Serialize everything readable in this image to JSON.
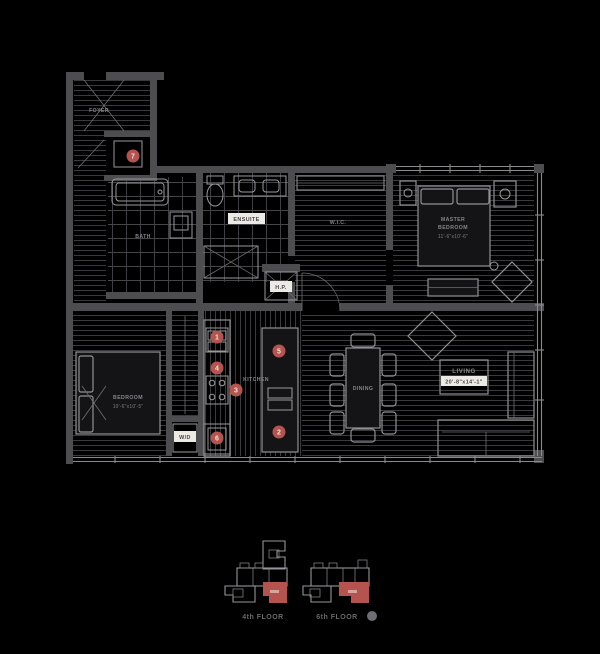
{
  "colors": {
    "background": "#000000",
    "wall": "#4d4d50",
    "furniture_line": "#919194",
    "room_text": "#8b8b8f",
    "chip_bg": "#eceae5",
    "marker_red": "#b5534f",
    "keyplan_unit_red": "#b5534f",
    "keyplan_line": "#96969a"
  },
  "rooms": {
    "foyer": {
      "label": "FOYER"
    },
    "bath": {
      "label": "BATH"
    },
    "ensuite": {
      "label": "ENSUITE"
    },
    "wic": {
      "label": "W.I.C."
    },
    "hp": {
      "label": "H.P."
    },
    "wd": {
      "label": "W/D"
    },
    "master": {
      "line1": "MASTER",
      "line2": "BEDROOM",
      "dims": "11'-6\"x10'-6\""
    },
    "bedroom": {
      "label": "BEDROOM",
      "dims": "10'-6\"x10'-5\""
    },
    "kitchen": {
      "label": "KITCHEN"
    },
    "dining": {
      "label": "DINING"
    },
    "living": {
      "label": "LIVING",
      "dims": "20'-8\"x14'-1\""
    }
  },
  "markers": [
    {
      "number": "1"
    },
    {
      "number": "2"
    },
    {
      "number": "3"
    },
    {
      "number": "4"
    },
    {
      "number": "5"
    },
    {
      "number": "6"
    },
    {
      "number": "7"
    }
  ],
  "keyplans": [
    {
      "label": "4th FLOOR"
    },
    {
      "label": "6th FLOOR"
    }
  ]
}
